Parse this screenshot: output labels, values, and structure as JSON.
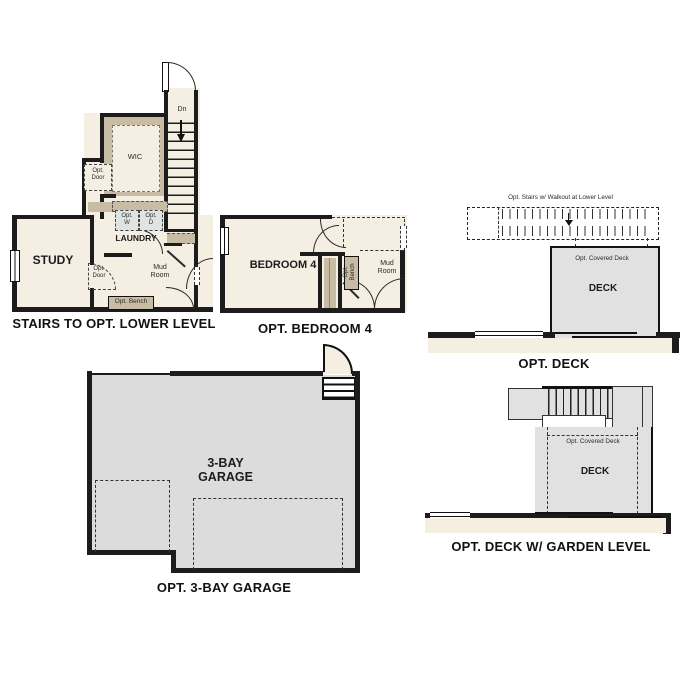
{
  "colors": {
    "wall": "#1c1c1c",
    "cream": "#f5eee2",
    "tan": "#c9bca4",
    "deckgray": "#e1e1e1",
    "garagegray": "#dcdcdc",
    "appliance": "#dfe4e3"
  },
  "plans": {
    "stairs_lower": {
      "title": "STAIRS TO OPT. LOWER LEVEL",
      "labels": {
        "dn": "Dn",
        "wic": "WIC",
        "opt_door_upper": "Opt.\nDoor",
        "opt_w": "Opt.\nW",
        "opt_d": "Opt.\nD",
        "laundry": "LAUNDRY",
        "study": "STUDY",
        "opt_door_study": "Opt.\nDoor",
        "mud_room": "Mud\nRoom",
        "opt_bench": "Opt. Bench"
      }
    },
    "bedroom4": {
      "title": "OPT. BEDROOM 4",
      "labels": {
        "bedroom": "BEDROOM 4",
        "opt_bench": "Opt. Bench",
        "mud_room": "Mud\nRoom"
      }
    },
    "deck": {
      "title": "OPT. DECK",
      "labels": {
        "stairs_note": "Opt. Stairs w/ Walkout at Lower Level",
        "covered": "Opt. Covered Deck",
        "deck": "DECK"
      }
    },
    "garage": {
      "title": "OPT. 3-BAY GARAGE",
      "labels": {
        "room": "3-BAY\nGARAGE"
      }
    },
    "deck_garden": {
      "title": "OPT. DECK W/ GARDEN LEVEL",
      "labels": {
        "covered": "Opt. Covered Deck",
        "deck": "DECK"
      }
    }
  }
}
